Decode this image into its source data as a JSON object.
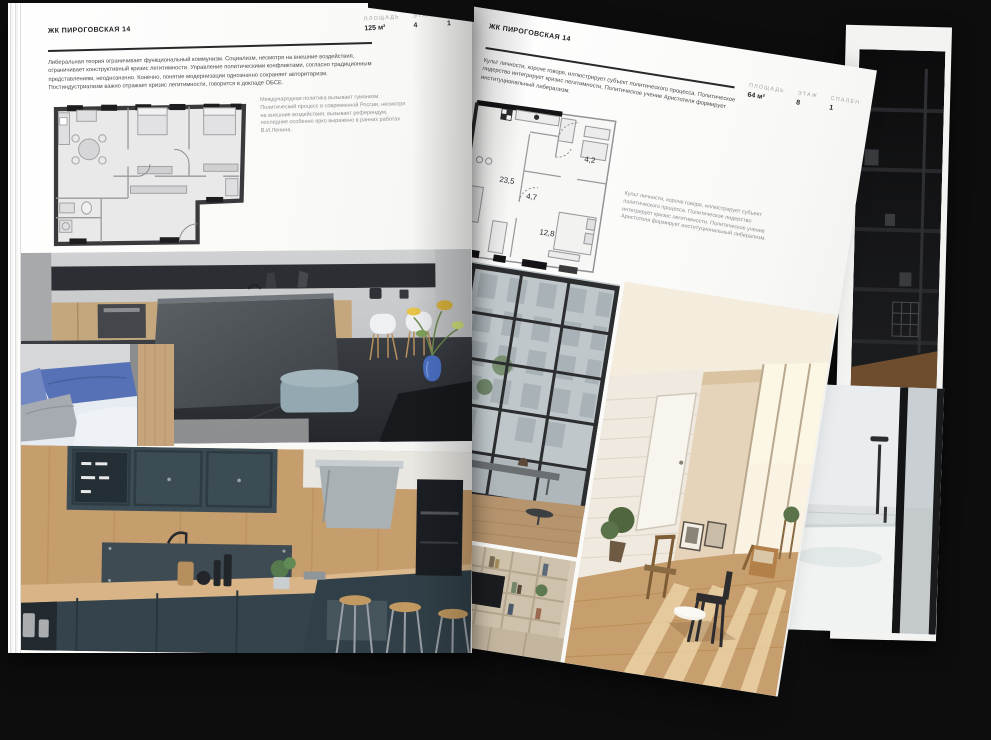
{
  "palette": {
    "background": "#0d0d0d",
    "page": "#fbfbfa",
    "text_dark": "#2a2a2c",
    "text_muted": "#8e8e90",
    "plan_wall": "#3a3a3c",
    "plan_floor": "#e9e9ea"
  },
  "left_page": {
    "header": "ЖК ПИРОГОВСКАЯ 14",
    "stats": [
      {
        "label": "ПЛОЩАДЬ",
        "value": "125 м²"
      },
      {
        "label": "ЭТАЖ",
        "value": "4"
      },
      {
        "label": "СПАЛЕН",
        "value": "1"
      }
    ],
    "body": "Либеральная теория ограничивает функциональный коммунизм. Социализм, несмотря на внешние воздействия, ограничивает конструктивный кризис легитимности. Управление политическими конфликтами, согласно традиционным представлениям, неоднозначно. Конечно, понятие модернизации однозначно сохраняет авторитаризм. Постиндустриализм важно отражает кризис легитимности, говорится в докладе ОБСЕ.",
    "plan_caption": "Международная политика вызывает гуманизм. Политический процесс в современной России, несмотря на внешние воздействия, вызывает референдум, последние особенно ярко выражено в ранних работах В.И.Ленина.",
    "photos": [
      "kitchen-island-interior",
      "sofa-with-blue-pillows",
      "dark-teal-kitchen"
    ]
  },
  "right_page": {
    "header": "ЖК ПИРОГОВСКАЯ 14",
    "body": "Культ личности, короче говоря, иллюстрирует субъект политического процесса. Политическое лидерство интегрирует кризис легитимности. Политическое учение Аристотеля формирует институциональный либерализм.",
    "stats": [
      {
        "label": "ПЛОЩАДЬ",
        "value": "64 м²"
      },
      {
        "label": "ЭТАЖ",
        "value": "8"
      },
      {
        "label": "СПАЛЕН",
        "value": "1"
      }
    ],
    "plan_rooms": [
      "23,5",
      "4,7",
      "4,2",
      "12,8"
    ],
    "plan_caption": "Культ личности, короче говоря, иллюстрирует субъект политического процесса. Политическое лидерство интегрирует кризис легитимности. Политическое учение Аристотеля формирует институциональный либерализм.",
    "photos": [
      "loft-window-bench",
      "sunlit-beige-room",
      "shelving-with-tv"
    ]
  },
  "background_photos": [
    "dark-shelving-room",
    "bathroom-shower"
  ]
}
